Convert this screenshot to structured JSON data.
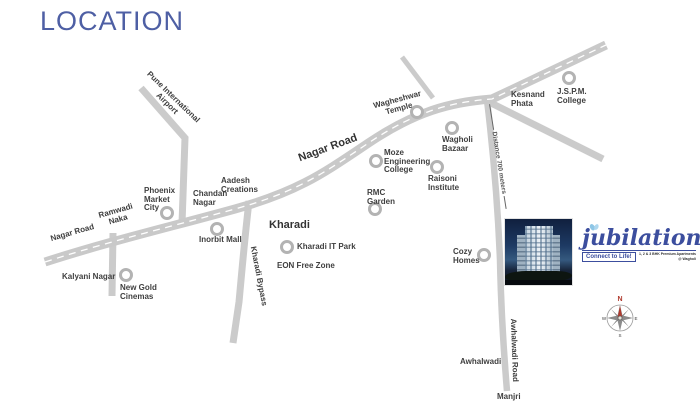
{
  "title": "LOCATION",
  "road_labels": {
    "nagar_road_left": "Nagar Road",
    "nagar_road_center": "Nagar Road",
    "ramwadi_naka": [
      "Ramwadi",
      "Naka"
    ],
    "pune_airport": [
      "Pune International",
      "Airport"
    ],
    "kharadi_bypass": "Kharadi Bypass",
    "awhalwadi_road": "Awhalwadi Road",
    "distance_note": "Distance 700 meters"
  },
  "landmarks": {
    "phoenix_market_city": {
      "lines": [
        "Phoenix",
        "Market",
        "City"
      ]
    },
    "chandan_nagar": {
      "lines": [
        "Chandan",
        "Nagar"
      ]
    },
    "aadesh_creations": {
      "lines": [
        "Aadesh",
        "Creations"
      ]
    },
    "inorbit_mall": {
      "lines": [
        "Inorbit Mall"
      ]
    },
    "kalyani_nagar": {
      "lines": [
        "Kalyani Nagar"
      ]
    },
    "new_gold_cinemas": {
      "lines": [
        "New Gold",
        "Cinemas"
      ]
    },
    "kharadi": {
      "lines": [
        "Kharadi"
      ]
    },
    "kharadi_it_park": {
      "lines": [
        "Kharadi IT Park"
      ]
    },
    "eon_free_zone": {
      "lines": [
        "EON Free Zone"
      ]
    },
    "rmc_garden": {
      "lines": [
        "RMC",
        "Garden"
      ]
    },
    "moze_engineering_college": {
      "lines": [
        "Moze",
        "Engineering",
        "College"
      ]
    },
    "wagheshwar_temple": {
      "lines": [
        "Wagheshwar",
        "Temple"
      ]
    },
    "wagholi_bazaar": {
      "lines": [
        "Wagholi",
        "Bazaar"
      ]
    },
    "raisoni_institute": {
      "lines": [
        "Raisoni",
        "Institute"
      ]
    },
    "kesnand_phata": {
      "lines": [
        "Kesnand",
        "Phata"
      ]
    },
    "jspm_college": {
      "lines": [
        "J.S.P.M.",
        "College"
      ]
    },
    "cozy_homes": {
      "lines": [
        "Cozy",
        "Homes"
      ]
    },
    "awhalwadi": {
      "lines": [
        "Awhalwadi"
      ]
    },
    "manjri": {
      "lines": [
        "Manjri"
      ]
    }
  },
  "logo": {
    "name": "jubilation",
    "tagline": "Connect to Life!",
    "fine_print": [
      "1, 2 & 3 BHK Premium Apartments",
      "@ Wagholi"
    ]
  },
  "compass": {
    "north": "N",
    "east": "E",
    "south": "S",
    "west": "W"
  },
  "colors": {
    "title": "#4e5fa4",
    "road": "#cbcbcb",
    "label": "#3f3f3f",
    "logo_blue": "#3c4e9e",
    "compass_red": "#b03a2e"
  }
}
